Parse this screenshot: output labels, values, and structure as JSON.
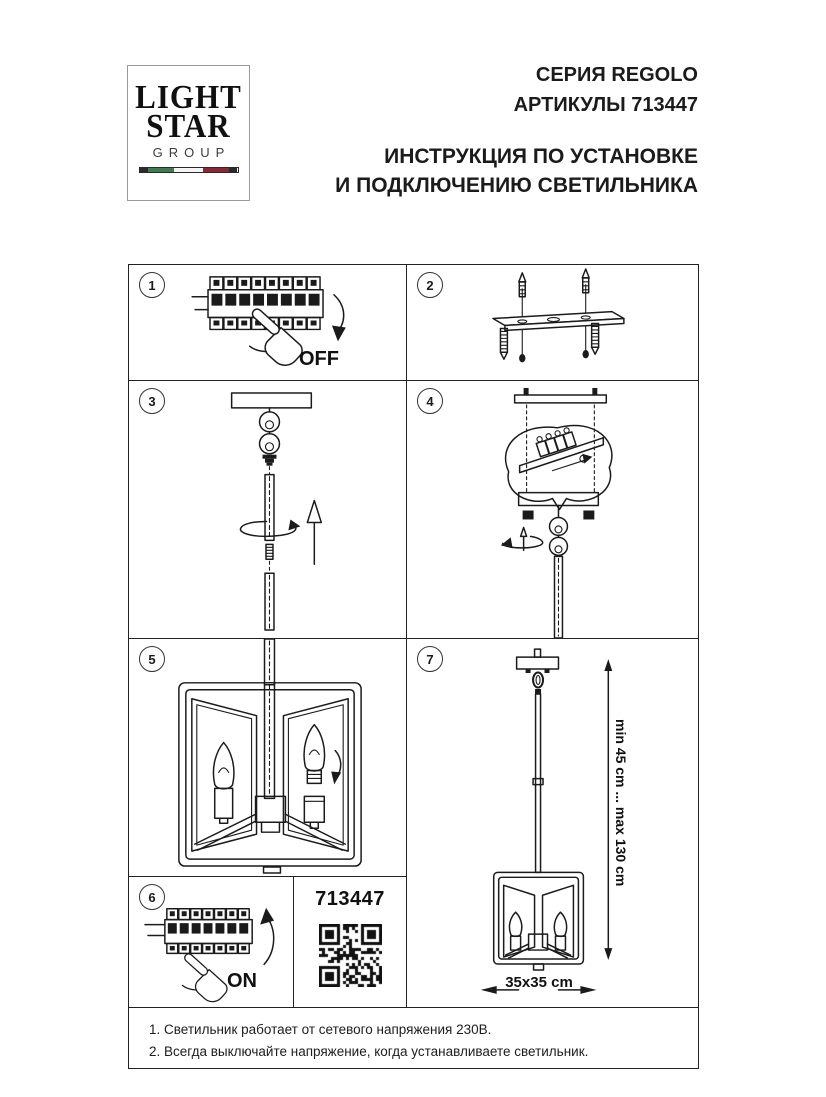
{
  "brand": {
    "logo_line1": "LIGHT",
    "logo_line2": "STAR",
    "logo_line3": "GROUP"
  },
  "header": {
    "series": "СЕРИЯ REGOLO",
    "articles": "АРТИКУЛЫ 713447",
    "title_line1": "ИНСТРУКЦИЯ ПО УСТАНОВКЕ",
    "title_line2": "И ПОДКЛЮЧЕНИЮ СВЕТИЛЬНИКА"
  },
  "steps": [
    {
      "num": "1",
      "label": "OFF"
    },
    {
      "num": "2"
    },
    {
      "num": "3"
    },
    {
      "num": "4"
    },
    {
      "num": "5"
    },
    {
      "num": "6",
      "label": "ON"
    },
    {
      "num": "7",
      "dim_vertical": "min 45 cm ... max 130 cm",
      "dim_horizontal": "35x35 cm"
    }
  ],
  "product": {
    "article": "713447"
  },
  "notes": {
    "line1": "1. Светильник работает от сетевого напряжения 230В.",
    "line2": "2. Всегда выключайте напряжение, когда устанавливаете светильник."
  },
  "colors": {
    "ink": "#1b1b1b",
    "flag_green": "#3e7d4e",
    "flag_red": "#8f2732",
    "flag_dark": "#2a2a2a"
  }
}
